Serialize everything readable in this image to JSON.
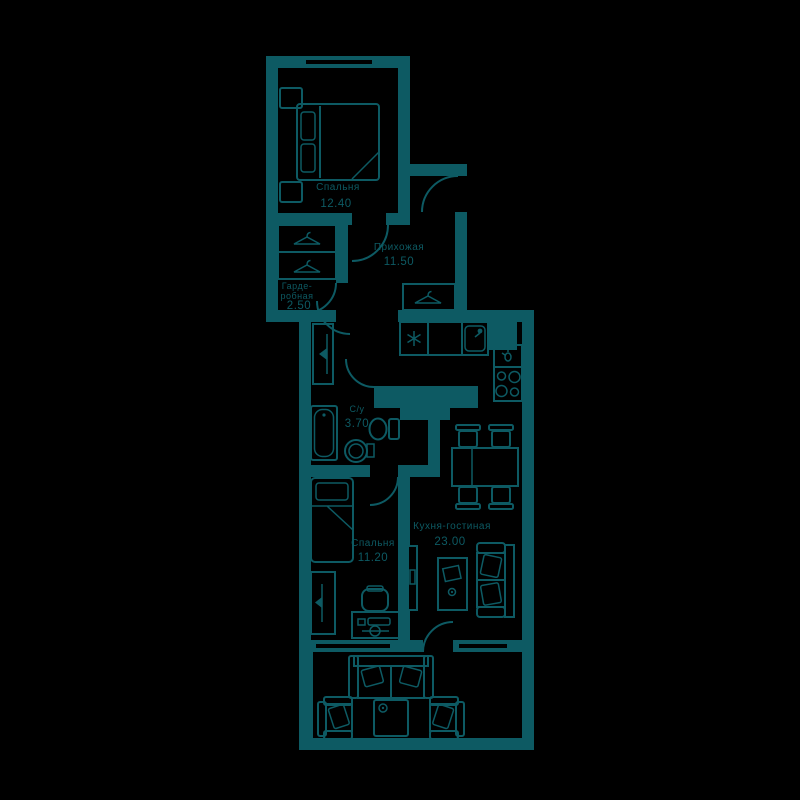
{
  "plan": {
    "type": "apartment-floor-plan",
    "background_color": "#000000",
    "line_color": "#0d5a63",
    "rooms": [
      {
        "id": "bedroom-1",
        "name": "Спальня",
        "area": "12.40"
      },
      {
        "id": "wardrobe-room",
        "name_line_1": "Гарде-",
        "name_line_2": "робная",
        "area": "2.50"
      },
      {
        "id": "hallway",
        "name": "Прихожая",
        "area": "11.50"
      },
      {
        "id": "bathroom",
        "name": "С/у",
        "area": "3.70"
      },
      {
        "id": "kitchen-living-room",
        "name": "Кухня-гостиная",
        "area": "23.00"
      },
      {
        "id": "bedroom-2",
        "name": "Спальня",
        "area": "11.20"
      }
    ]
  }
}
